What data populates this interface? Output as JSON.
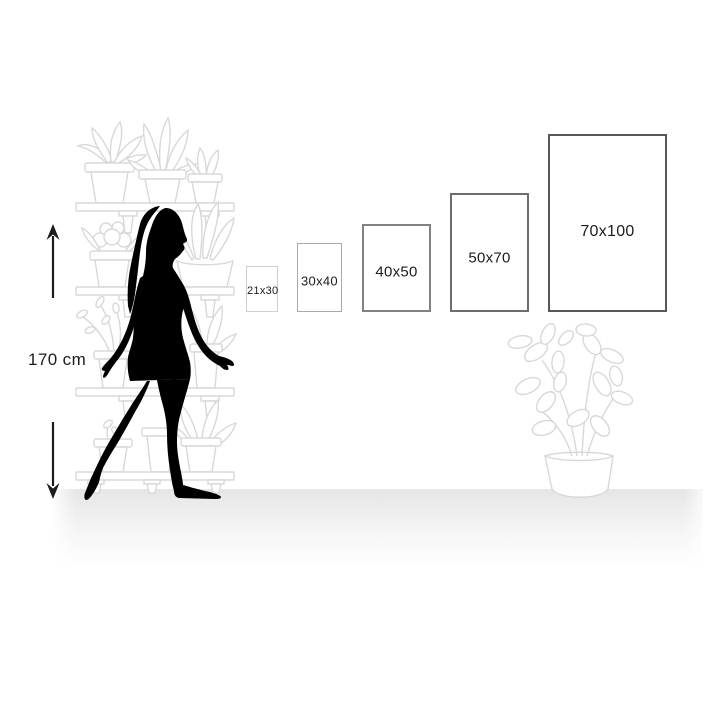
{
  "figure": {
    "type": "print-size-comparison",
    "description_labels": [
      "21x30",
      "30x40",
      "40x50",
      "50x70",
      "70x100"
    ],
    "person_height": "170 cm"
  },
  "measurement": {
    "height_label": "170 cm"
  },
  "frames": [
    {
      "label": "21x30",
      "x": 246,
      "y": 266,
      "w": 32,
      "h": 46,
      "border_color": "#cfcfcf",
      "border_width": 1,
      "font_size": 11
    },
    {
      "label": "30x40",
      "x": 297,
      "y": 243,
      "w": 45,
      "h": 69,
      "border_color": "#a9a9a9",
      "border_width": 1,
      "font_size": 13
    },
    {
      "label": "40x50",
      "x": 362,
      "y": 224,
      "w": 69,
      "h": 88,
      "border_color": "#828282",
      "border_width": 2,
      "font_size": 15
    },
    {
      "label": "50x70",
      "x": 450,
      "y": 193,
      "w": 79,
      "h": 119,
      "border_color": "#6d6d6d",
      "border_width": 2,
      "font_size": 15
    },
    {
      "label": "70x100",
      "x": 548,
      "y": 134,
      "w": 119,
      "h": 178,
      "border_color": "#575757",
      "border_width": 2,
      "font_size": 16
    }
  ],
  "colors": {
    "background": "#ffffff",
    "silhouette": "#000000",
    "line_art": "#d8d8d8",
    "text": "#1c1c1c",
    "arrow": "#1c1c1c",
    "floor_shadow": "#2b2b2b"
  }
}
